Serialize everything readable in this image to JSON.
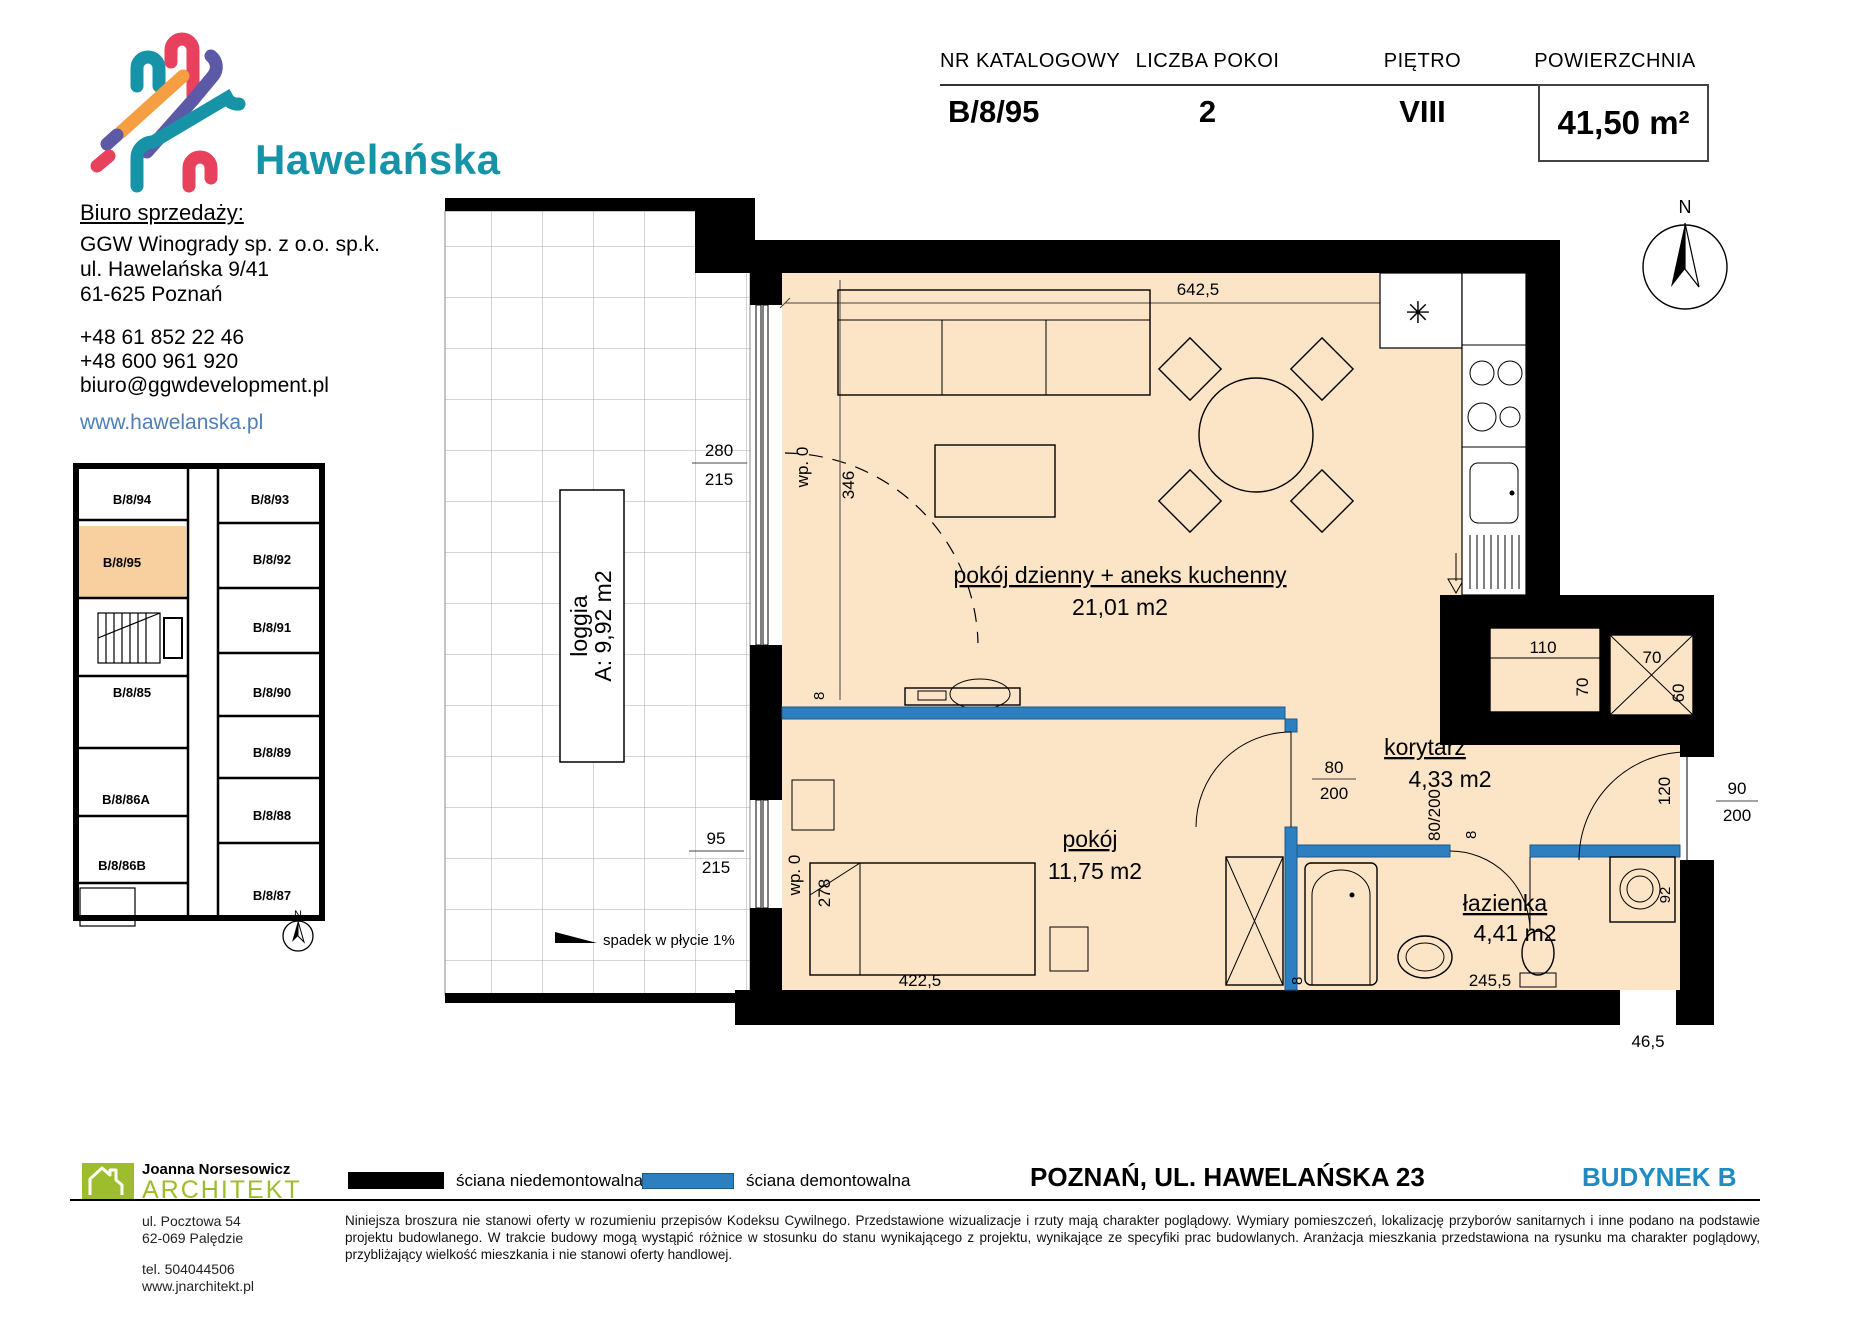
{
  "header": {
    "cols": [
      {
        "label": "NR KATALOGOWY",
        "value": "B/8/95"
      },
      {
        "label": "LICZBA POKOI",
        "value": "2"
      },
      {
        "label": "PIĘTRO",
        "value": "VIII"
      },
      {
        "label": "POWIERZCHNIA",
        "value": "41,50 m²"
      }
    ]
  },
  "brand": {
    "name": "Hawelańska"
  },
  "sales": {
    "heading": "Biuro sprzedaży:",
    "company": "GGW Winogrady sp. z o.o. sp.k.",
    "addr1": "ul. Hawelańska 9/41",
    "addr2": "61-625 Poznań",
    "phone1": "+48 61 852 22 46",
    "phone2": "+48 600 961 920",
    "email": "biuro@ggwdevelopment.pl",
    "site": "www.hawelanska.pl"
  },
  "mini": {
    "highlighted_unit": "B/8/95",
    "units": [
      "B/8/94",
      "B/8/93",
      "B/8/95",
      "B/8/92",
      "B/8/91",
      "B/8/85",
      "B/8/90",
      "B/8/89",
      "B/8/86A",
      "B/8/88",
      "B/8/86B",
      "B/8/87"
    ],
    "compass": "N"
  },
  "plan": {
    "compass": "N",
    "rooms": {
      "living": {
        "name": "pokój dzienny + aneks kuchenny",
        "area": "21,01 m2"
      },
      "bedroom": {
        "name": "pokój",
        "area": "11,75 m2"
      },
      "corridor": {
        "name": "korytarz",
        "area": "4,33 m2"
      },
      "bath": {
        "name": "łazienka",
        "area": "4,41 m2"
      },
      "loggia": {
        "name": "loggia",
        "area": "A: 9,92 m2"
      }
    },
    "notes": {
      "slope": "spadek w płycie 1%"
    },
    "symbols": {
      "boiler": "✳"
    },
    "dims": {
      "living_width": "642,5",
      "win1_w": "280",
      "win1_h": "215",
      "win1_note": "wp. 0",
      "win1_len": "346",
      "kitchen_len": "272",
      "shaft1_w": "110",
      "shaft1_h": "70",
      "shaft2_w": "70",
      "shaft2_h": "60",
      "entry_w": "90",
      "entry_h": "200",
      "entry_side": "120",
      "hall_w": "80",
      "hall_h": "200",
      "bath_door": "80/200",
      "win2_w": "95",
      "win2_h": "215",
      "win2_note": "wp. 0",
      "win2_len": "278",
      "wall_a": "8",
      "wall_e": "8",
      "bed_width": "422,5",
      "bath_width": "245,5",
      "notch": "46,5",
      "washer": "92",
      "corner": "70"
    }
  },
  "legend": {
    "fixed": "ściana niedemontowalna",
    "removable": "ściana demontowalna"
  },
  "footer": {
    "city": "POZNAŃ, UL. HAWELAŃSKA 23",
    "building": "BUDYNEK B",
    "disclaimer": "Niniejsza broszura nie stanowi oferty w rozumieniu przepisów Kodeksu Cywilnego. Przedstawione wizualizacje i rzuty mają charakter poglądowy. Wymiary pomieszczeń, lokalizację przyborów sanitarnych i inne podano na podstawie projektu budowlanego. W trakcie budowy mogą wystąpić różnice w stosunku do stanu wynikającego z projektu, wynikające ze specyfiki prac budowlanych. Aranżacja mieszkania przedstawiona na rysunku ma charakter poglądowy, przybliżający wielkość mieszkania i nie stanowi oferty handlowej."
  },
  "architect": {
    "name": "Joanna Norsesowicz",
    "title": "ARCHITEKT",
    "addr1": "ul. Pocztowa 54",
    "addr2": "62-069 Palędzie",
    "tel": "tel. 504044506",
    "site": "www.jnarchitekt.pl"
  },
  "colors": {
    "accent_teal": "#1793a8",
    "link_blue": "#4d7fb8",
    "building_blue": "#1e8bc3",
    "removable_wall_blue": "#2e7fc0",
    "room_fill": "#fce4c6",
    "mini_highlight": "#f8d0a0",
    "architect_green": "#9ebd2d"
  }
}
